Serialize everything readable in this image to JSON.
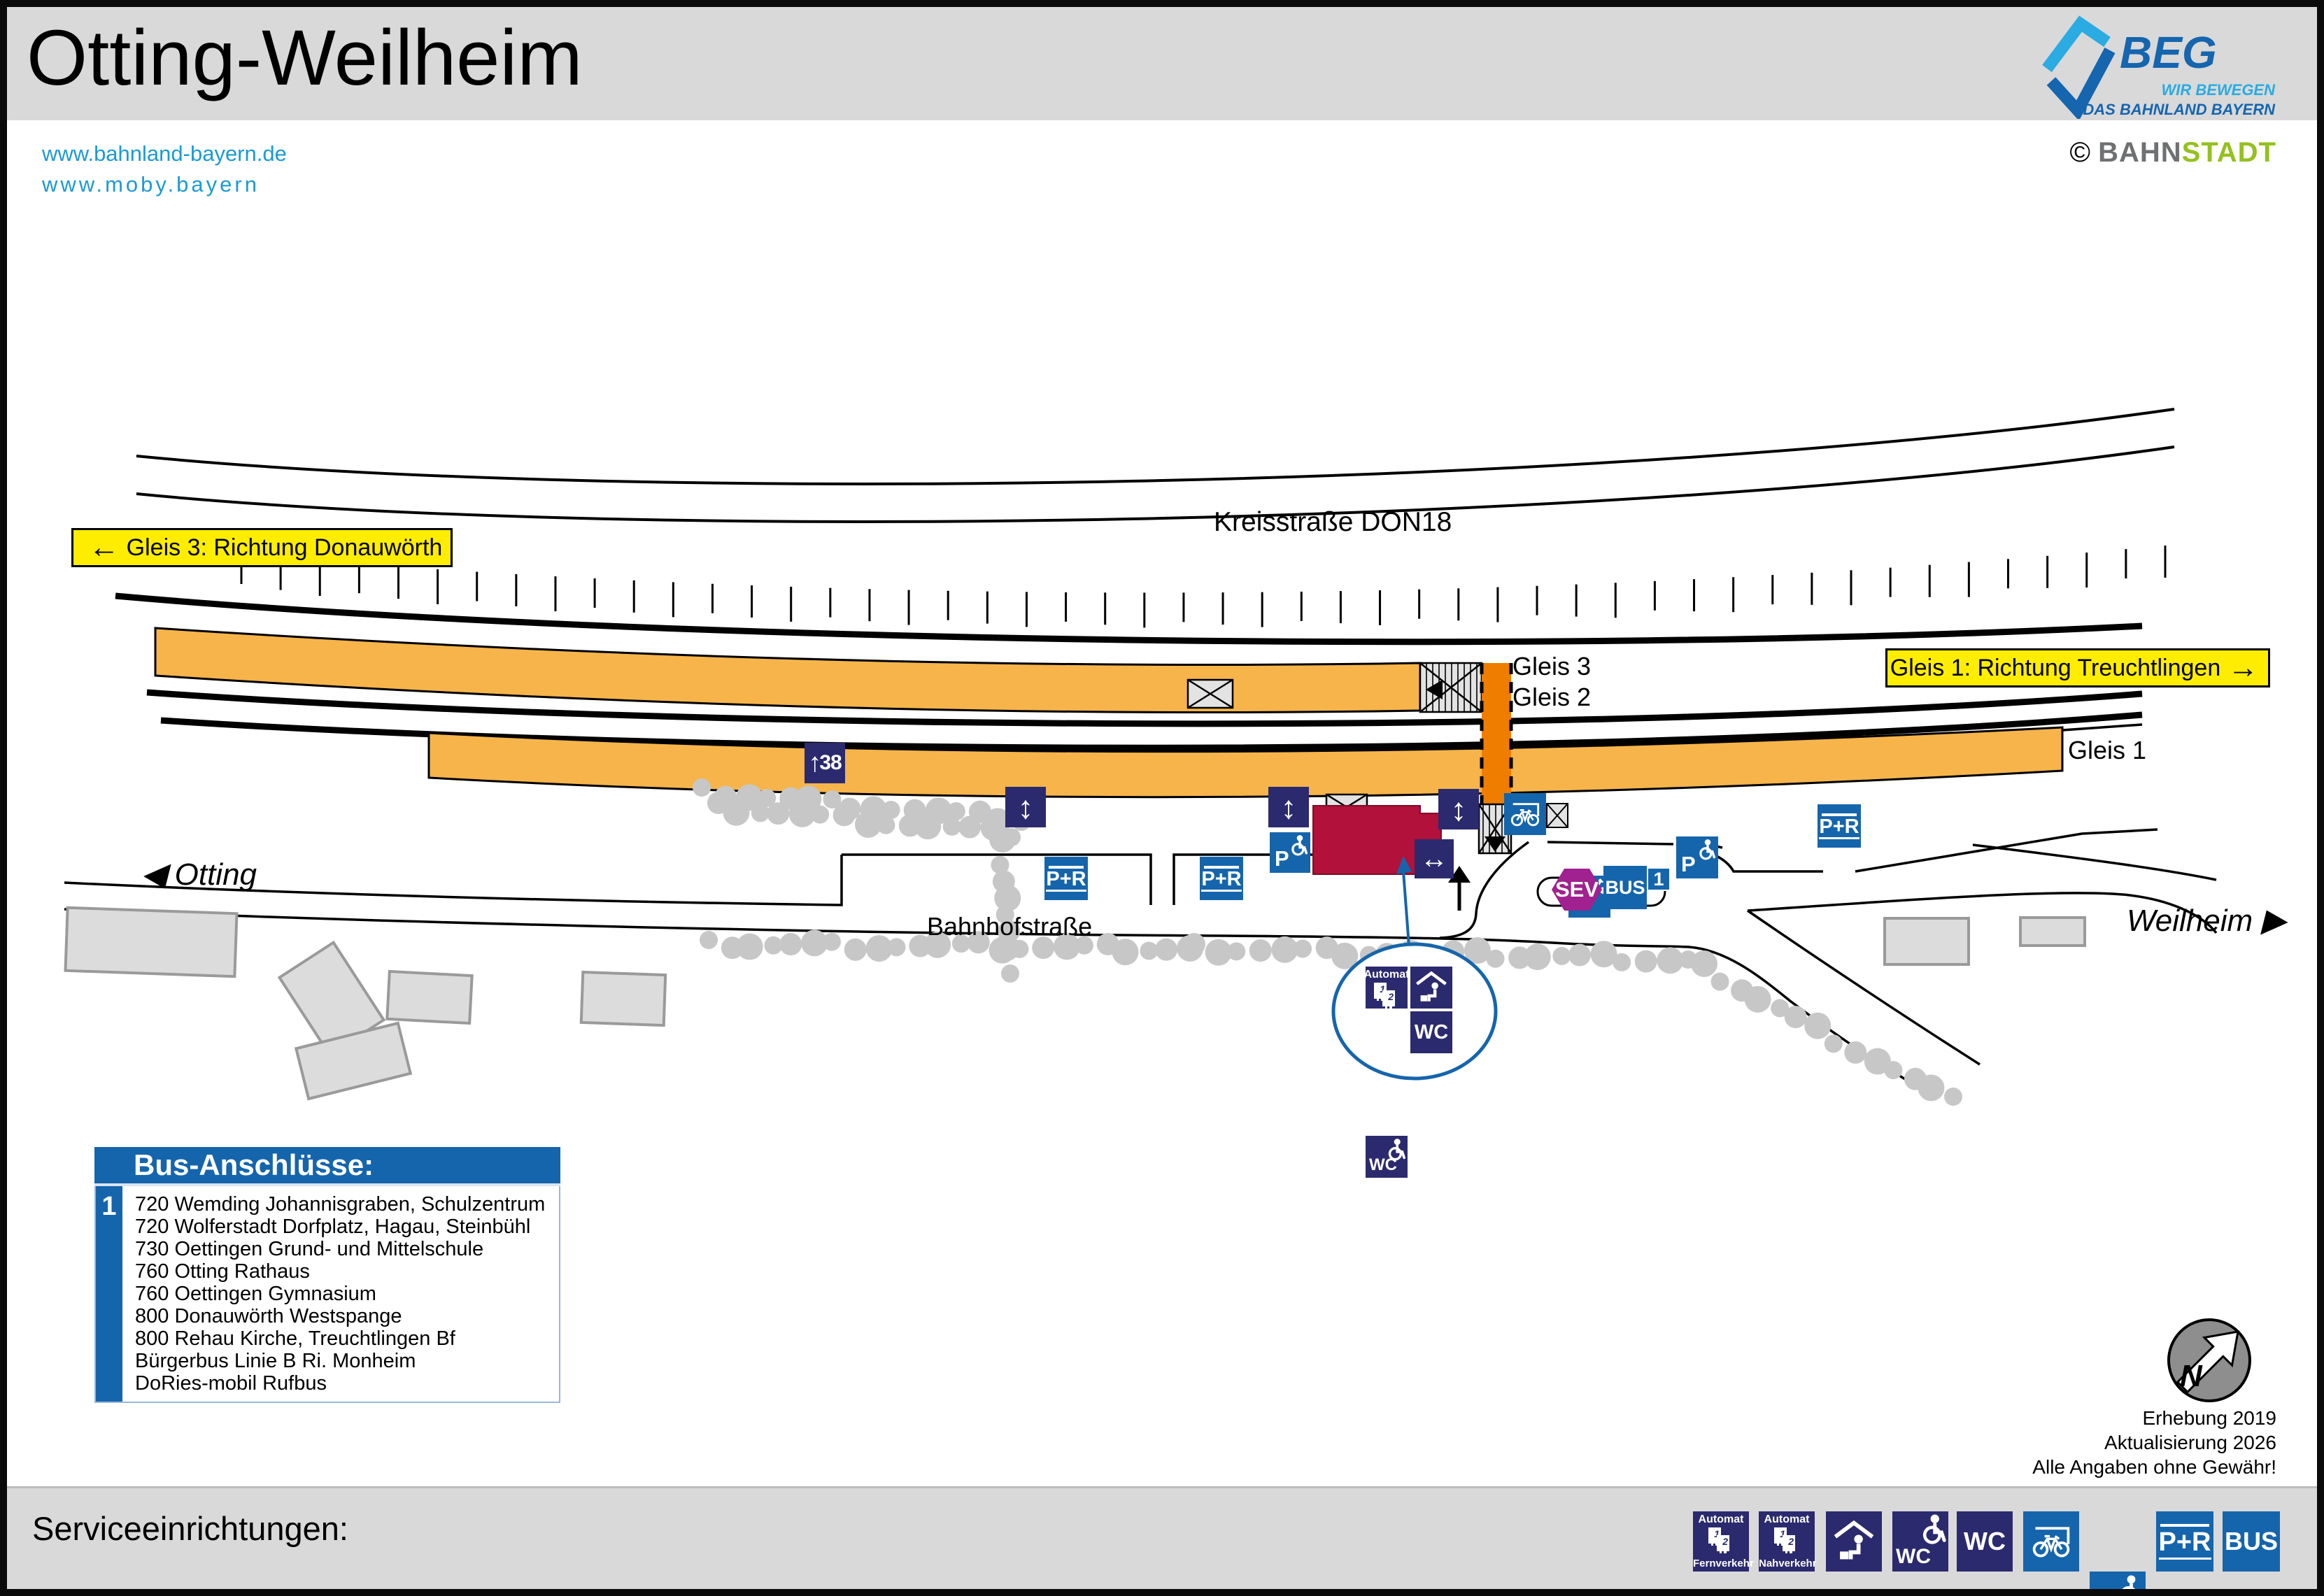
{
  "header": {
    "title": "Otting-Weilheim",
    "links": [
      "www.bahnland-bayern.de",
      "www.moby.bayern"
    ],
    "beg": {
      "name": "BEG",
      "tagline1": "WIR BEWEGEN",
      "tagline2": "DAS BAHNLAND BAYERN"
    },
    "credit": {
      "copyright": "©",
      "part1": "BAHN",
      "part2": "STADT"
    }
  },
  "map": {
    "road_label": "Kreisstraße DON18",
    "street_label": "Bahnhofstraße",
    "direction_left": {
      "arrow": "←",
      "label": "Gleis 3: Richtung Donauwörth"
    },
    "direction_right": {
      "label": "Gleis 1: Richtung Treuchtlingen",
      "arrow": "→"
    },
    "place_left": {
      "arrow": "◀",
      "label": "Otting"
    },
    "place_right": {
      "label": "Weilheim",
      "arrow": "▶"
    },
    "tracks": {
      "gleis1": "Gleis 1",
      "gleis2": "Gleis 2",
      "gleis3": "Gleis 3"
    },
    "icons": {
      "arrow_updown": "↕",
      "arrow_leftright": "↔",
      "arrow_up": "↑",
      "platform_height": "38",
      "p": "P",
      "pr": "P+R",
      "bus": "BUS",
      "bus_stop_number": "1",
      "sev": "SEV",
      "wc": "WC",
      "automat": "Automat",
      "ticket1": "1",
      "ticket2": "2",
      "fernverkehr": "Fernverkehr",
      "nahverkehr": "Nahverkehr"
    }
  },
  "bus_box": {
    "title": "Bus-Anschlüsse:",
    "stop_number": "1",
    "lines": [
      "720 Wemding Johannisgraben, Schulzentrum",
      "720 Wolferstadt Dorfplatz, Hagau, Steinbühl",
      "730 Oettingen Grund- und Mittelschule",
      "760 Otting Rathaus",
      "760 Oettingen Gymnasium",
      "800 Donauwörth Westspange",
      "800 Rehau Kirche, Treuchtlingen Bf",
      "Bürgerbus Linie B Ri. Monheim",
      "DoRies-mobil Rufbus"
    ]
  },
  "notes": {
    "line1": "Erhebung 2019",
    "line2": "Aktualisierung 2026",
    "line3": "Alle Angaben ohne Gewähr!"
  },
  "legend": {
    "title": "Serviceeinrichtungen:",
    "items": [
      {
        "name": "ticket-machine-longdistance"
      },
      {
        "name": "ticket-machine-local"
      },
      {
        "name": "waiting-area"
      },
      {
        "name": "wc-accessible"
      },
      {
        "name": "wc"
      },
      {
        "name": "bike-parking"
      },
      {
        "name": "accessible-parking"
      },
      {
        "name": "park-and-ride"
      },
      {
        "name": "bus"
      }
    ]
  },
  "colors": {
    "header_gray": "#d9d9d9",
    "link_blue": "#1b9ad6",
    "yellow_sign": "#ffed00",
    "navy_icon": "#2b2a6e",
    "blue_icon": "#1565ac",
    "sev_purple": "#a0218f",
    "platform_orange": "#f6b44b",
    "crossing_orange": "#ef7d00",
    "station_red": "#b1113a",
    "beg_dark_blue": "#1565af",
    "beg_light_blue": "#2aabe2",
    "stadt_green": "#94c11f"
  }
}
